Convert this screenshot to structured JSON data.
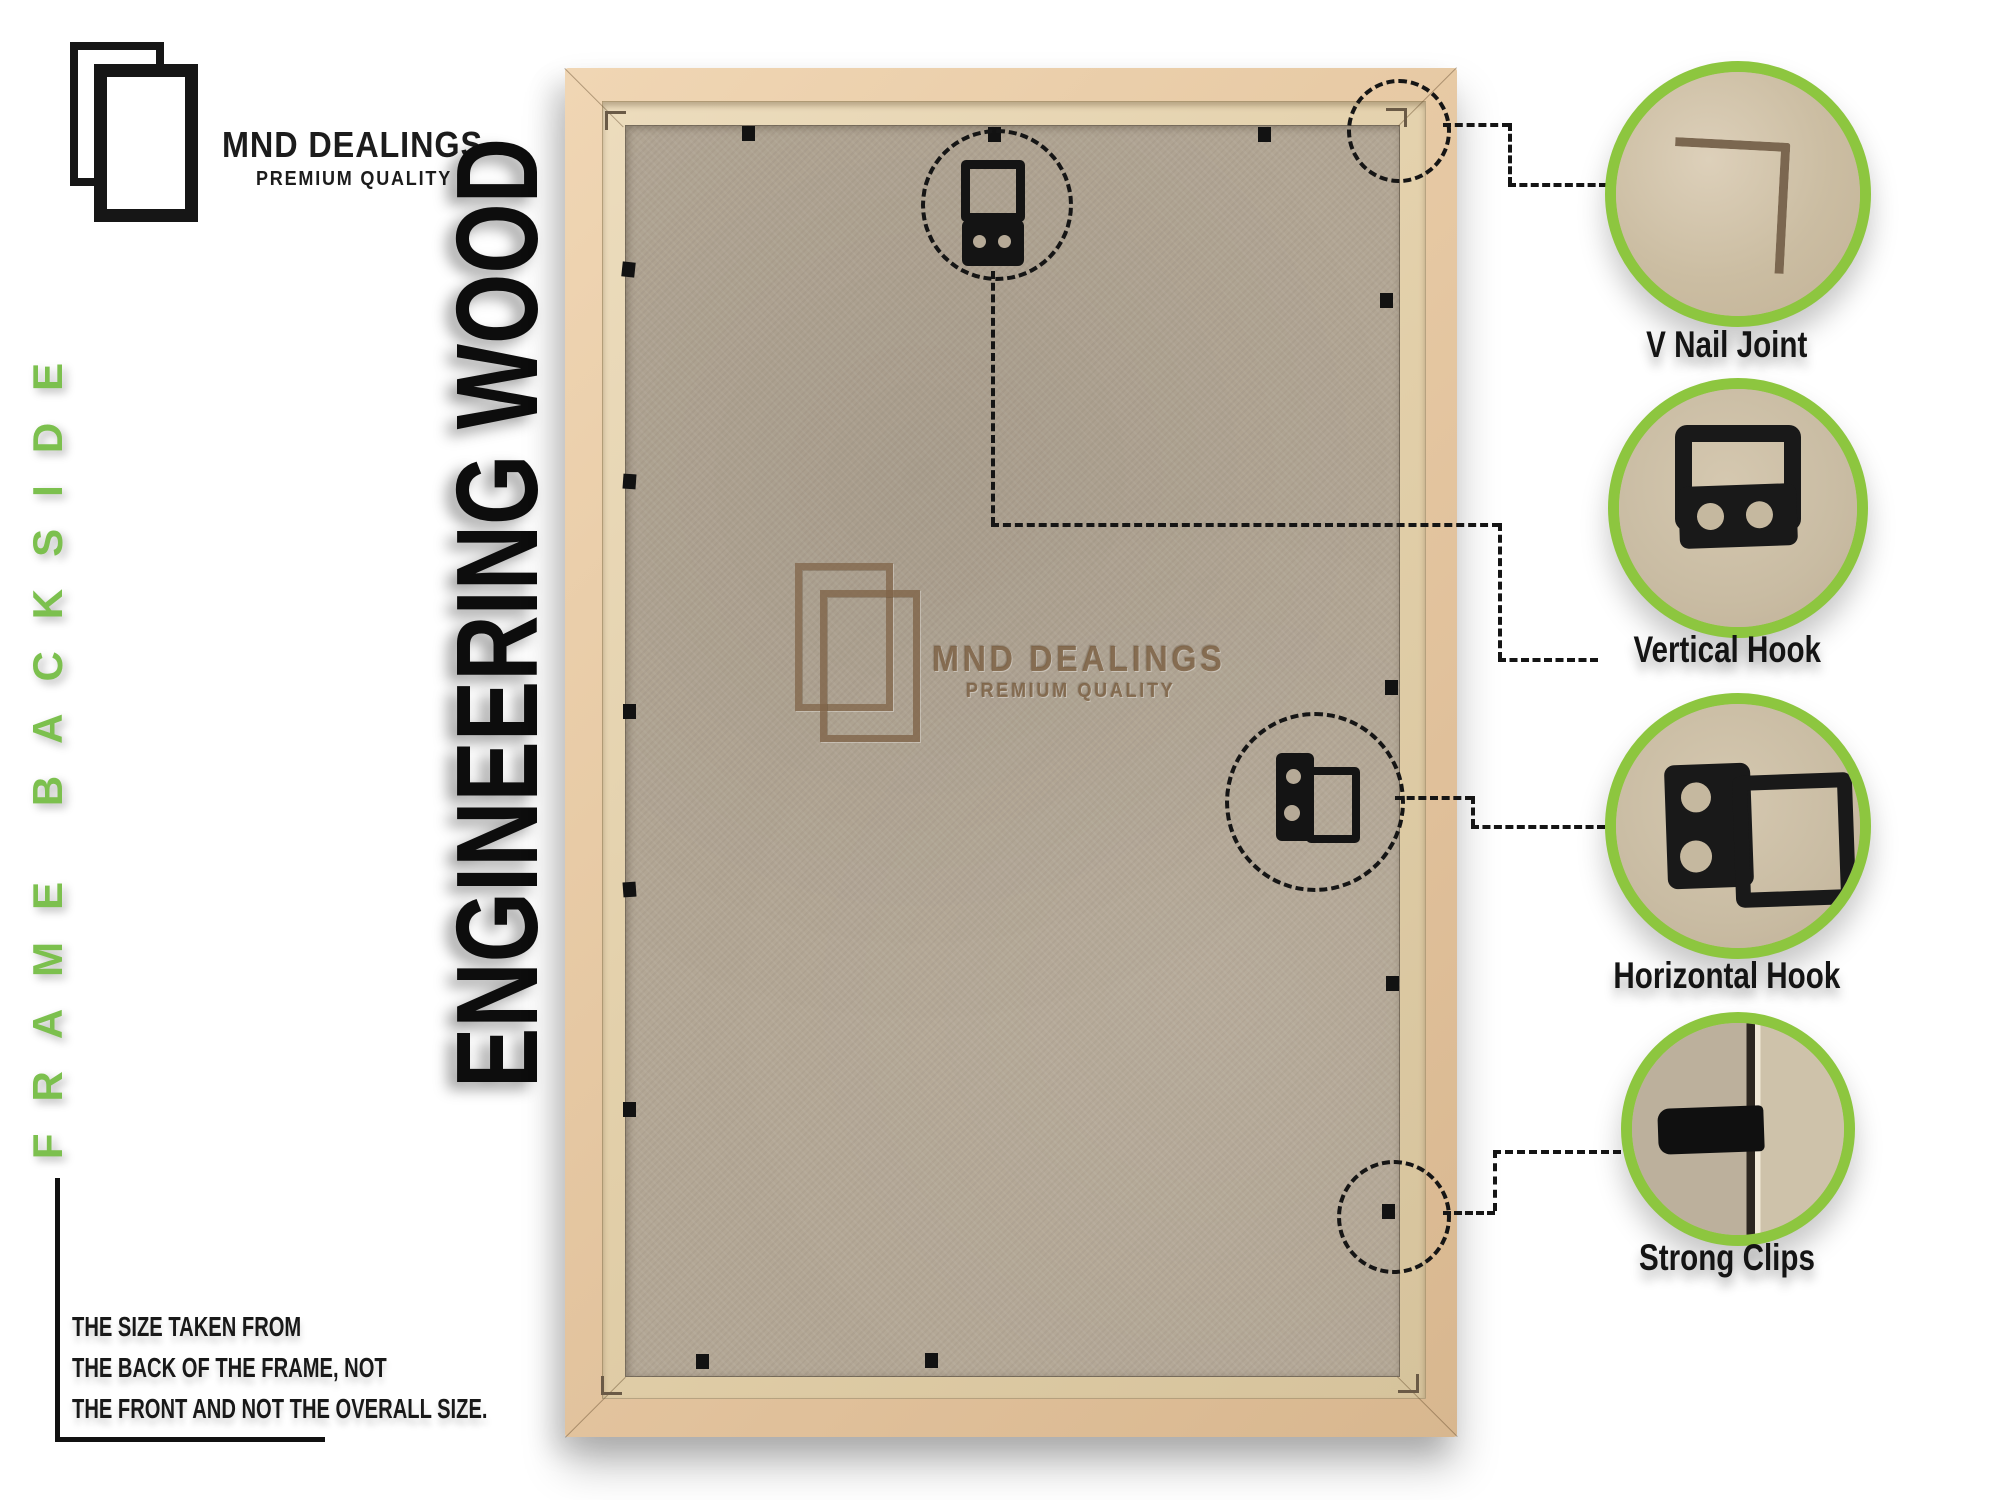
{
  "brand": {
    "name": "MND DEALINGS",
    "tagline": "PREMIUM QUALITY"
  },
  "side_label": "FRAME BACKSIDE",
  "material_label": "ENGINEERING WOOD",
  "size_note": {
    "lines": [
      "THE SIZE TAKEN FROM",
      "THE BACK OF THE FRAME, NOT",
      "THE FRONT AND NOT THE OVERALL SIZE."
    ]
  },
  "watermark": {
    "name": "MND DEALINGS",
    "tagline": "PREMIUM QUALITY"
  },
  "callouts": [
    {
      "id": "v-nail-joint",
      "label": "V Nail Joint"
    },
    {
      "id": "vertical-hook",
      "label": "Vertical Hook"
    },
    {
      "id": "horizontal-hook",
      "label": "Horizontal Hook"
    },
    {
      "id": "strong-clips",
      "label": "Strong Clips"
    }
  ],
  "colors": {
    "accent_green": "#8dc63f",
    "side_label_green": "#7cc04e",
    "wood": "#e8cba6",
    "wood_lip": "#e2cfa9",
    "mdf_board": "#b3a795",
    "ink": "#151515"
  }
}
